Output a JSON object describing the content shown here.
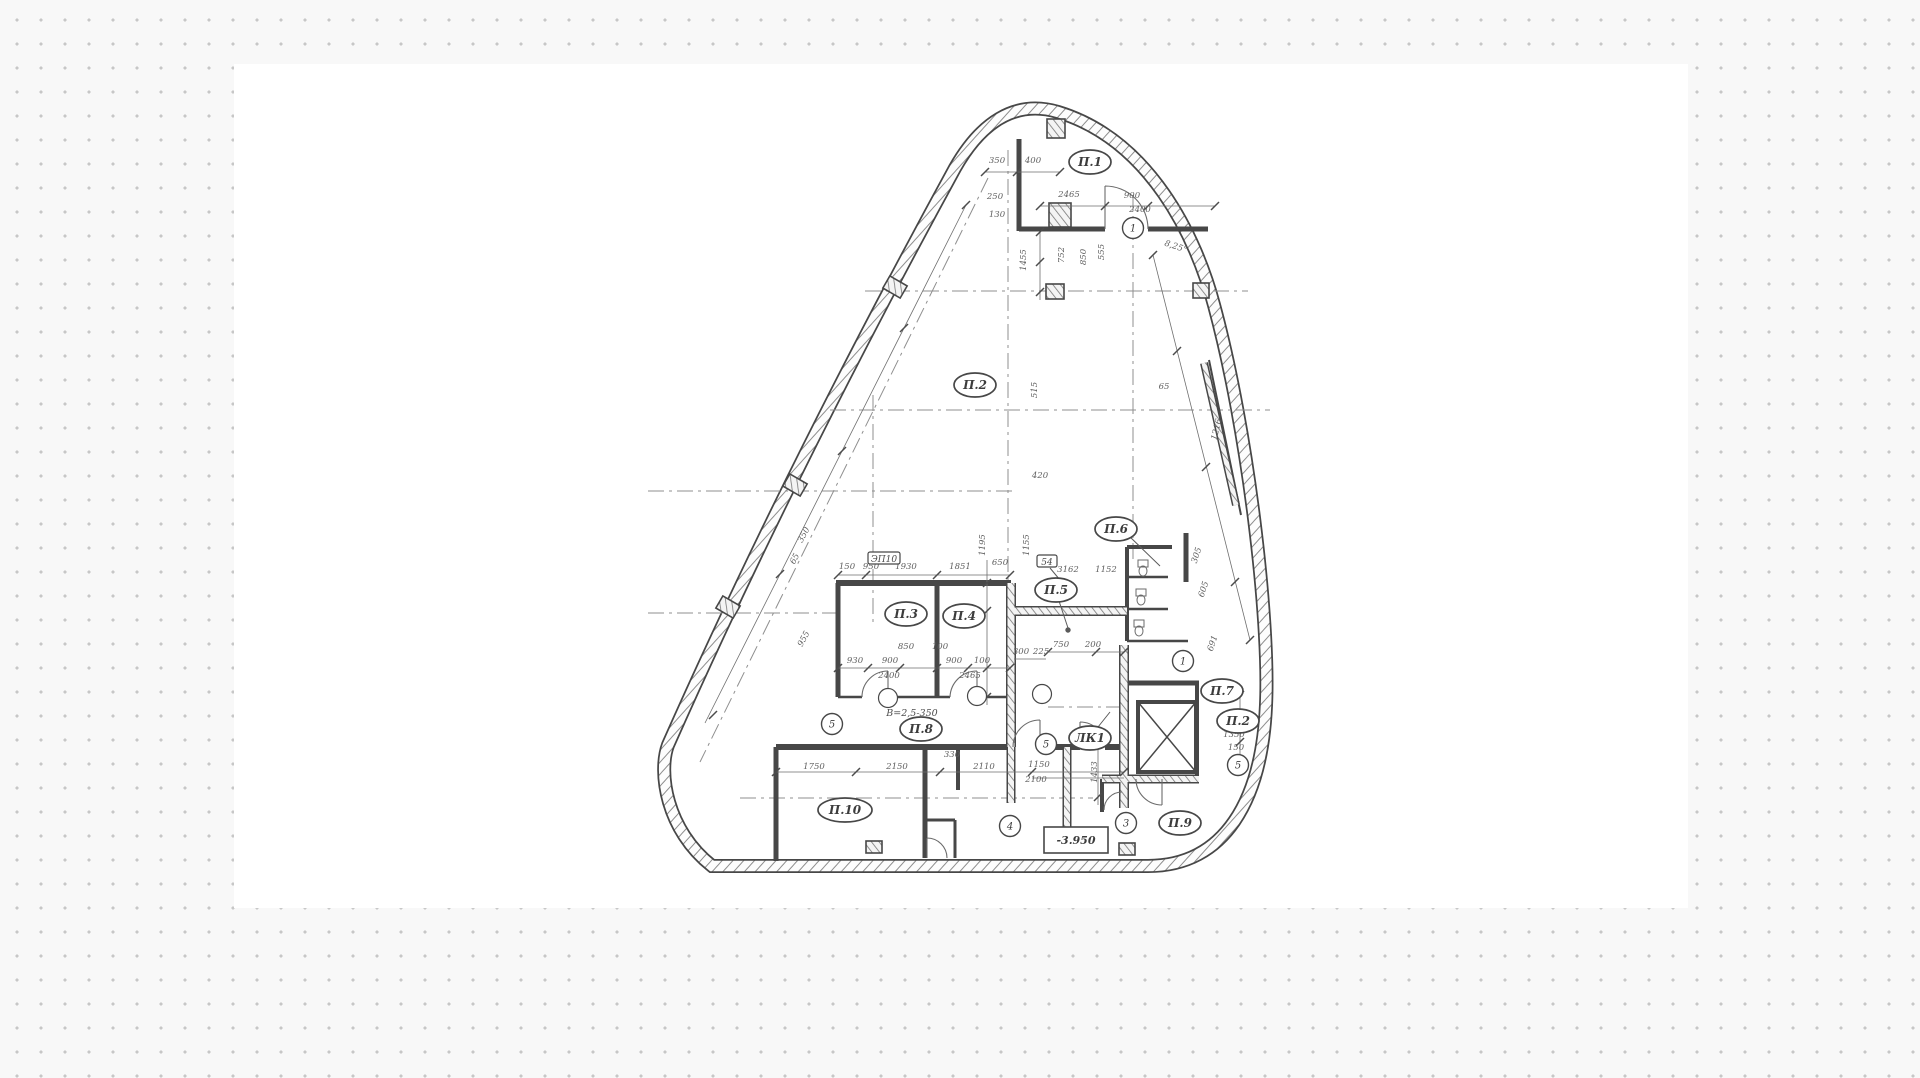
{
  "canvas": {
    "background": "#ffffff",
    "dot_color": "#c7c7c7",
    "page_background": "#f8f8f8"
  },
  "drawing": {
    "ink_color": "#474747",
    "elevation": {
      "t": "-3.950",
      "x": 1076,
      "y": 844
    },
    "note": {
      "t": "В=2,5-350",
      "x": 912,
      "y": 716
    },
    "tags": [
      {
        "t": "ЭП10",
        "x": 884,
        "y": 561
      },
      {
        "t": "54",
        "x": 1047,
        "y": 564
      }
    ],
    "rooms": [
      {
        "label": "П.1",
        "x": 1090,
        "y": 162
      },
      {
        "label": "П.2",
        "x": 975,
        "y": 385
      },
      {
        "label": "П.3",
        "x": 906,
        "y": 614
      },
      {
        "label": "П.4",
        "x": 964,
        "y": 616
      },
      {
        "label": "П.5",
        "x": 1056,
        "y": 590
      },
      {
        "label": "П.6",
        "x": 1116,
        "y": 529
      },
      {
        "label": "П.7",
        "x": 1222,
        "y": 691
      },
      {
        "label": "П.2",
        "x": 1238,
        "y": 721
      },
      {
        "label": "П.8",
        "x": 921,
        "y": 729
      },
      {
        "label": "ЛК1",
        "x": 1090,
        "y": 738
      },
      {
        "label": "П.9",
        "x": 1180,
        "y": 823
      },
      {
        "label": "П.10",
        "x": 845,
        "y": 810
      }
    ],
    "bubbles": [
      {
        "n": "1",
        "x": 1133,
        "y": 228
      },
      {
        "n": "1",
        "x": 1183,
        "y": 661
      },
      {
        "n": "3",
        "x": 1126,
        "y": 823
      },
      {
        "n": "4",
        "x": 1010,
        "y": 826
      },
      {
        "n": "5",
        "x": 832,
        "y": 724
      },
      {
        "n": "5",
        "x": 1046,
        "y": 744
      },
      {
        "n": "5",
        "x": 1238,
        "y": 765
      }
    ],
    "door_markers": [
      {
        "x": 888,
        "y": 698
      },
      {
        "x": 977,
        "y": 696
      },
      {
        "x": 1042,
        "y": 694
      }
    ],
    "dims": [
      {
        "t": "350",
        "x": 997,
        "y": 163
      },
      {
        "t": "400",
        "x": 1033,
        "y": 163
      },
      {
        "t": "250",
        "x": 995,
        "y": 199
      },
      {
        "t": "130",
        "x": 997,
        "y": 217
      },
      {
        "t": "2465",
        "x": 1069,
        "y": 197
      },
      {
        "t": "900",
        "x": 1132,
        "y": 198
      },
      {
        "t": "2400",
        "x": 1140,
        "y": 212
      },
      {
        "t": "1455",
        "x": 1026,
        "y": 260,
        "r": -90
      },
      {
        "t": "752",
        "x": 1064,
        "y": 255,
        "r": -90
      },
      {
        "t": "850",
        "x": 1086,
        "y": 257,
        "r": -90
      },
      {
        "t": "555",
        "x": 1104,
        "y": 252,
        "r": -90
      },
      {
        "t": "8,25°",
        "x": 1175,
        "y": 249,
        "r": 18
      },
      {
        "t": "65",
        "x": 1164,
        "y": 389
      },
      {
        "t": "1216",
        "x": 1219,
        "y": 430,
        "r": -76
      },
      {
        "t": "305",
        "x": 1199,
        "y": 556,
        "r": -72
      },
      {
        "t": "605",
        "x": 1206,
        "y": 590,
        "r": -72
      },
      {
        "t": "691",
        "x": 1215,
        "y": 644,
        "r": -72
      },
      {
        "t": "515",
        "x": 1037,
        "y": 390,
        "r": -90
      },
      {
        "t": "1195",
        "x": 985,
        "y": 545,
        "r": -90
      },
      {
        "t": "1155",
        "x": 1029,
        "y": 545,
        "r": -90
      },
      {
        "t": "420",
        "x": 1040,
        "y": 478
      },
      {
        "t": "350",
        "x": 806,
        "y": 536,
        "r": -62
      },
      {
        "t": "65",
        "x": 797,
        "y": 560,
        "r": -62
      },
      {
        "t": "955",
        "x": 806,
        "y": 640,
        "r": -62
      },
      {
        "t": "150",
        "x": 847,
        "y": 569
      },
      {
        "t": "950",
        "x": 871,
        "y": 569
      },
      {
        "t": "1930",
        "x": 906,
        "y": 569
      },
      {
        "t": "1851",
        "x": 960,
        "y": 569
      },
      {
        "t": "650",
        "x": 1000,
        "y": 565
      },
      {
        "t": "3162",
        "x": 1068,
        "y": 572
      },
      {
        "t": "1152",
        "x": 1106,
        "y": 572
      },
      {
        "t": "850",
        "x": 906,
        "y": 649
      },
      {
        "t": "100",
        "x": 940,
        "y": 649
      },
      {
        "t": "930",
        "x": 855,
        "y": 663
      },
      {
        "t": "900",
        "x": 890,
        "y": 663
      },
      {
        "t": "900",
        "x": 954,
        "y": 663
      },
      {
        "t": "100",
        "x": 982,
        "y": 663
      },
      {
        "t": "2400",
        "x": 889,
        "y": 678
      },
      {
        "t": "2465",
        "x": 970,
        "y": 678
      },
      {
        "t": "300",
        "x": 1021,
        "y": 654
      },
      {
        "t": "225",
        "x": 1041,
        "y": 654
      },
      {
        "t": "750",
        "x": 1061,
        "y": 647
      },
      {
        "t": "200",
        "x": 1093,
        "y": 647
      },
      {
        "t": "1350",
        "x": 1234,
        "y": 737
      },
      {
        "t": "150",
        "x": 1236,
        "y": 750
      },
      {
        "t": "1433",
        "x": 1097,
        "y": 772,
        "r": -90
      },
      {
        "t": "1750",
        "x": 814,
        "y": 769
      },
      {
        "t": "2150",
        "x": 897,
        "y": 769
      },
      {
        "t": "2110",
        "x": 984,
        "y": 769
      },
      {
        "t": "1150",
        "x": 1039,
        "y": 767
      },
      {
        "t": "2100",
        "x": 1036,
        "y": 782
      },
      {
        "t": "330",
        "x": 952,
        "y": 757
      }
    ]
  }
}
